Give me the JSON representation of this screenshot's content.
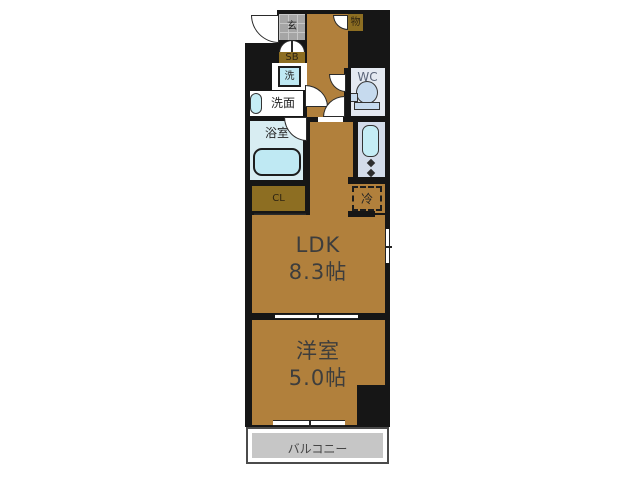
{
  "figure": "japanese-apartment-floorplan",
  "rooms": {
    "entrance": {
      "label": "玄"
    },
    "storage": {
      "label": "物"
    },
    "shoe_box": {
      "label": "SB"
    },
    "washer": {
      "label": "洗"
    },
    "wc": {
      "label": "WC"
    },
    "washroom": {
      "label": "洗面"
    },
    "bathroom": {
      "label": "浴室"
    },
    "closet": {
      "label": "CL"
    },
    "refrigerator": {
      "label": "冷"
    },
    "ldk": {
      "label": "LDK",
      "size": "8.3帖"
    },
    "western_room": {
      "label": "洋室",
      "size": "5.0帖"
    },
    "balcony": {
      "label": "バルコニー"
    }
  },
  "colors": {
    "wall": "#161616",
    "floor_brown": "#b1803c",
    "closet_olive": "#8d6e22",
    "entrance_tile": "#a5a5a5",
    "fixture_cyan": "#bfe9f3",
    "counter_blue": "#d3dcea",
    "wc_fill": "#e4e9f1",
    "bath_fill": "#d8edf2",
    "balcony_gray": "#c6c6c6",
    "background": "#ffffff"
  }
}
